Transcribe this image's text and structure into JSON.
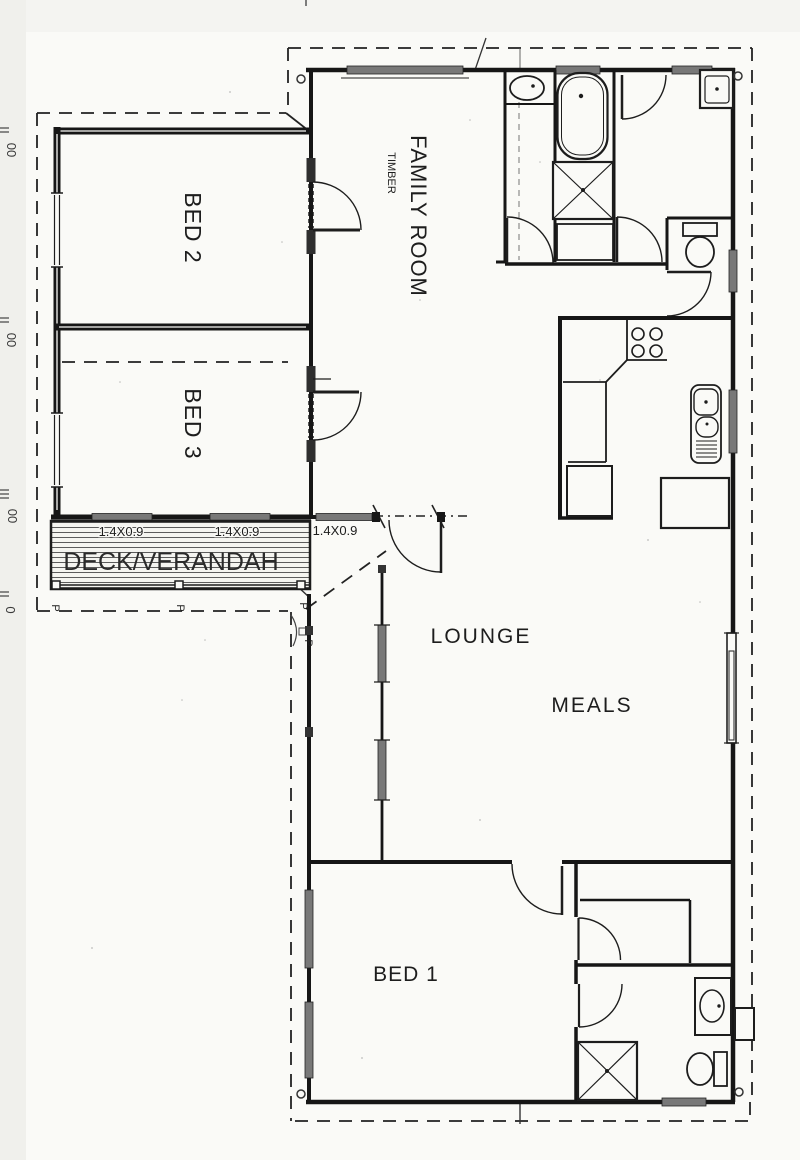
{
  "drawing": {
    "kind": "house floor plan (scanned)",
    "colors": {
      "wall": "#161616",
      "window_glass": "#787878",
      "paper": "#fafaf7",
      "dashed_roofline": "#222222",
      "text": "#1d1d1d"
    }
  },
  "rooms": {
    "bed1": "BED 1",
    "bed2": "BED 2",
    "bed3": "BED 3",
    "family_room": "FAMILY ROOM",
    "family_room_material": "TIMBER",
    "lounge": "LOUNGE",
    "meals": "MEALS",
    "deck": "DECK/VERANDAH"
  },
  "window_dimensions": {
    "deck_window_1": "1.4X0.9",
    "deck_window_2": "1.4X0.9",
    "family_window": "1.4X0.9"
  },
  "deck_posts": {
    "label": "P"
  },
  "scan_edge_marks": {
    "mark1": "00",
    "mark2": "00",
    "mark3": "00",
    "mark4": "0"
  }
}
